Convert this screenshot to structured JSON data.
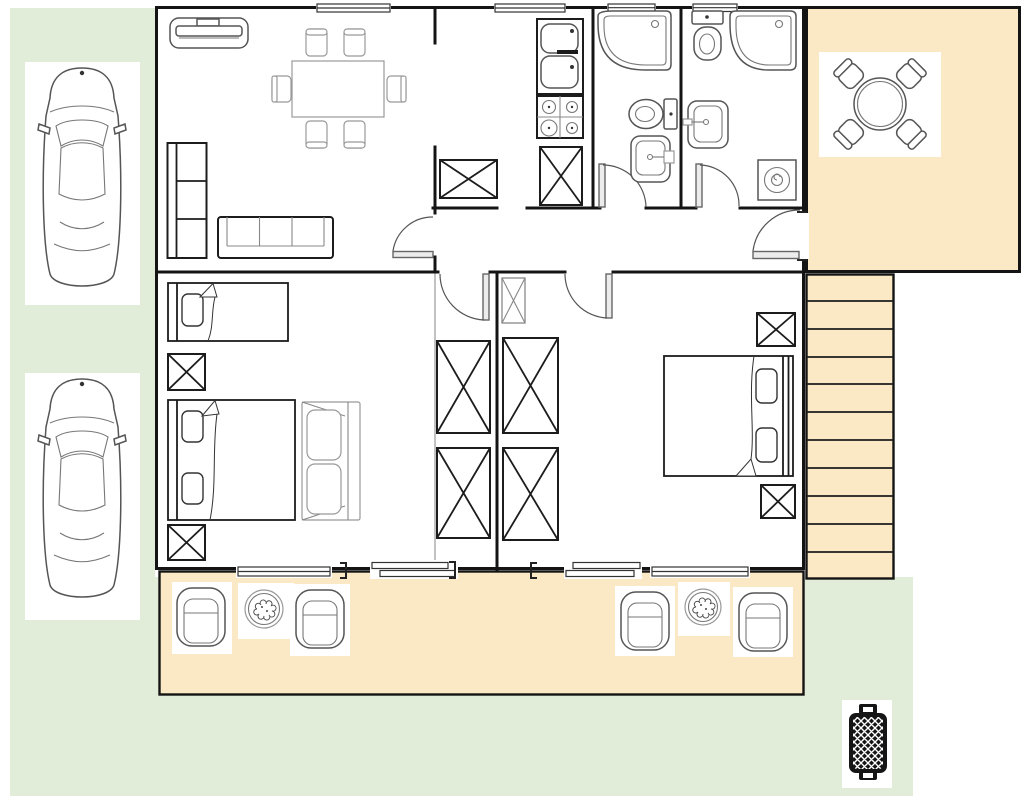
{
  "scene": {
    "kind": "architectural-floor-plan-top-view",
    "width_px": 1024,
    "height_px": 807,
    "has_text_labels": false
  },
  "colors": {
    "lawn": "#e2edd9",
    "deck": "#fae9c4",
    "wall": "#141414",
    "floor": "#ffffff",
    "stroke_dark": "#1c1c1c",
    "stroke_mid": "#555555",
    "stroke_light": "#999999",
    "grill": "#151515"
  },
  "areas": [
    {
      "name": "lawn-left-strip"
    },
    {
      "name": "lawn-bottom"
    },
    {
      "name": "house-floor-plan"
    },
    {
      "name": "deck-top-right"
    },
    {
      "name": "staircase"
    },
    {
      "name": "deck-bottom"
    }
  ],
  "symbols": [
    {
      "name": "car-top-view",
      "count": 2
    },
    {
      "name": "tv-cabinet",
      "count": 1
    },
    {
      "name": "shelf-unit",
      "count": 1
    },
    {
      "name": "sofa-3-seat",
      "count": 1
    },
    {
      "name": "dining-table",
      "count": 1
    },
    {
      "name": "dining-chair",
      "count": 6
    },
    {
      "name": "kitchen-double-sink",
      "count": 1
    },
    {
      "name": "gas-stove-4-burner",
      "count": 1
    },
    {
      "name": "corner-bathtub",
      "count": 2
    },
    {
      "name": "toilet",
      "count": 2
    },
    {
      "name": "washbasin",
      "count": 2
    },
    {
      "name": "washing-machine",
      "count": 1
    },
    {
      "name": "single-bed",
      "count": 1
    },
    {
      "name": "double-bed",
      "count": 2
    },
    {
      "name": "wardrobe-crossed-box",
      "count": 4
    },
    {
      "name": "cabinet-crossed-box",
      "count": 7
    },
    {
      "name": "loveseat-sofa",
      "count": 1
    },
    {
      "name": "interior-door",
      "count": 6
    },
    {
      "name": "window",
      "count": 6
    },
    {
      "name": "sliding-door",
      "count": 2
    },
    {
      "name": "stair-treads",
      "count": 11
    },
    {
      "name": "round-patio-table",
      "count": 1
    },
    {
      "name": "patio-chair",
      "count": 4
    },
    {
      "name": "outdoor-armchair",
      "count": 4
    },
    {
      "name": "potted-plant",
      "count": 2
    },
    {
      "name": "bbq-grill",
      "count": 1
    }
  ]
}
